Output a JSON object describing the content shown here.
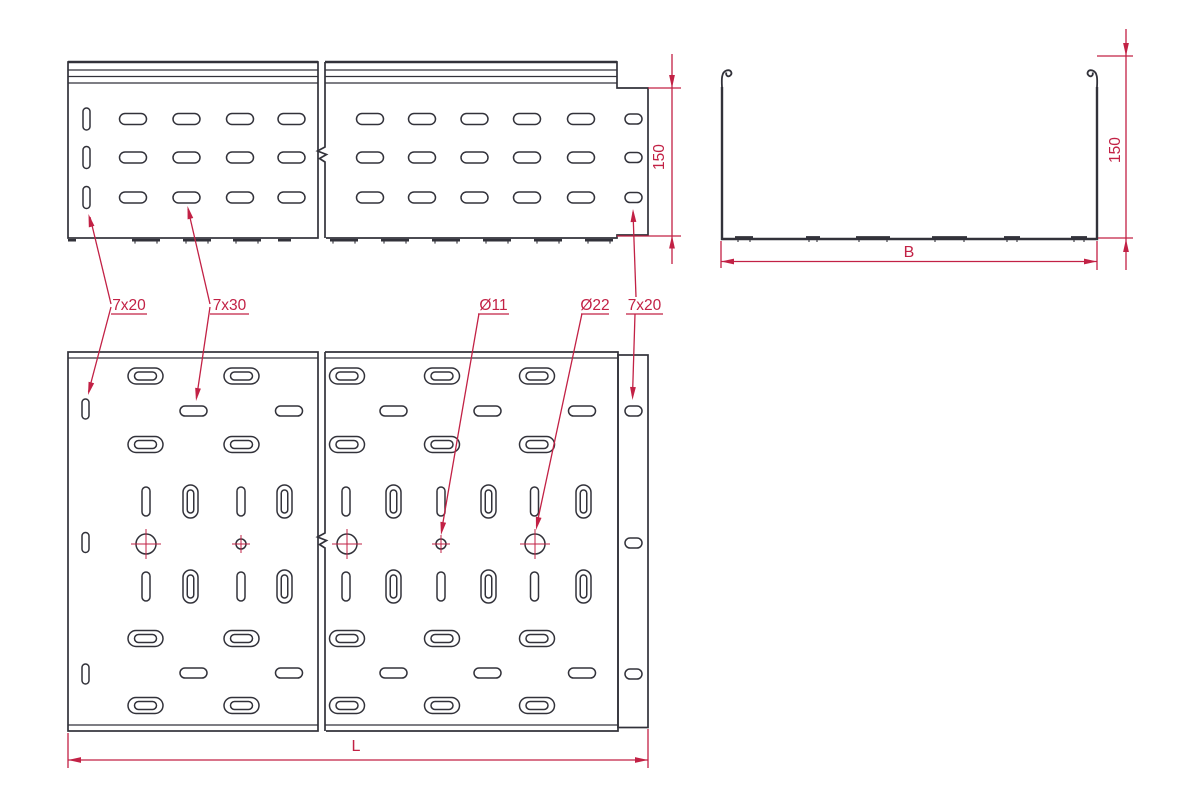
{
  "drawing": {
    "background": "#ffffff",
    "line_color": "#32323a",
    "accent_color": "#c22145",
    "labels": {
      "slot_small": "7x20",
      "slot_large": "7x30",
      "hole_small": "Ø11",
      "hole_large": "Ø22",
      "slot_end": "7x20",
      "side_height": "150",
      "section_height": "150",
      "width": "B",
      "length": "L"
    }
  }
}
